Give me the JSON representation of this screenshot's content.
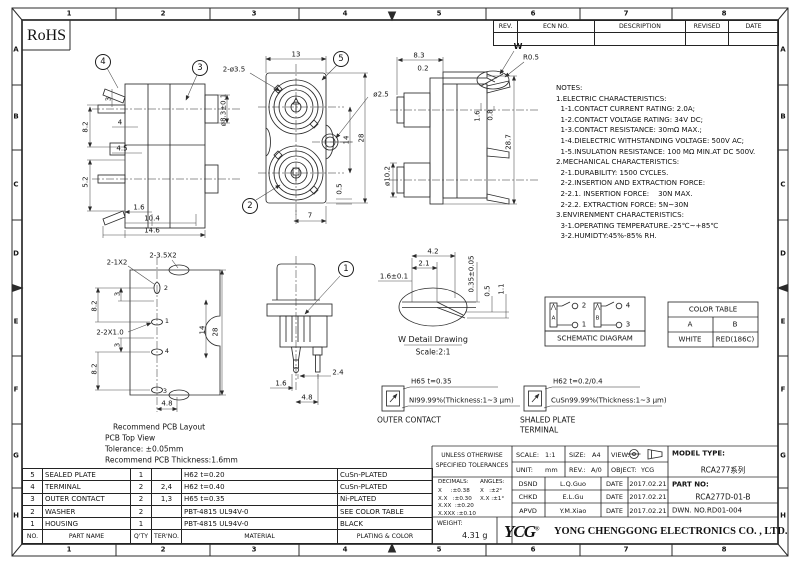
{
  "meta": {
    "background": "#ffffff",
    "line_color": "#2b2b2b",
    "text_color": "#111111"
  },
  "sheet": {
    "rohs_label": "RoHS"
  },
  "border": {
    "columns": [
      "1",
      "2",
      "3",
      "4",
      "5",
      "6",
      "7",
      "8"
    ],
    "rows": [
      "A",
      "B",
      "C",
      "D",
      "E",
      "F",
      "G",
      "H"
    ]
  },
  "revision_table": {
    "headers": [
      "REV.",
      "ECN NO.",
      "DESCRIPTION",
      "REVISED",
      "DATE"
    ]
  },
  "notes": {
    "title": "NOTES:",
    "lines": [
      "1.ELECTRIC CHARACTERISTICS:",
      "  1-1.CONTACT CURRENT RATING: 2.0A;",
      "  1-2.CONTACT VOLTAGE RATING: 34V DC;",
      "  1-3.CONTACT RESISTANCE: 30mΩ MAX.;",
      "  1-4.DIELECTRIC WITHSTANDING VOLTAGE: 500V AC;",
      "  1-5.INSULATION RESISTANCE: 100 MΩ MIN.AT DC 500V.",
      "2.MECHANICAL CHARACTERISTICS:",
      "  2-1.DURABILITY: 1500 CYCLES.",
      "  2-2.INSERTION AND EXTRACTION FORCE:",
      "  2-2.1. INSERTION FORCE:    30N MAX.",
      "  2-2.2. EXTRACTION FORCE: 5N~30N",
      "3.ENVIRENMENT CHARACTERISTICS:",
      "  3-1.OPERATING TEMPERATURE.-25℃~+85℃",
      "  3-2.HUMIDTY:45%-85% RH."
    ]
  },
  "views": {
    "dual_side": {
      "balloon_sealed_plate": "4",
      "balloon_outer_contact": "3",
      "dims": [
        "3",
        "8.2",
        "4",
        "4.5",
        "5.2",
        "1.6",
        "10.4",
        "14.6",
        "ø8.3±0.1"
      ]
    },
    "front": {
      "balloon_housing": "5",
      "balloon_washer": "2",
      "dims": [
        "13",
        "2-ø3.5",
        "ø2.5",
        "14",
        "28",
        "0.5",
        "7"
      ]
    },
    "right_side": {
      "detail_marker": "W",
      "dims": [
        "8.3",
        "0.2",
        "R0.5",
        "1.6",
        "0.8",
        "28.7",
        "ø10.2"
      ]
    },
    "pcb": {
      "dims": [
        "2-1X2",
        "2-3.5X2",
        "2-2X1.0",
        "3",
        "8.2",
        "3",
        "8.2",
        "14",
        "28",
        "4.8"
      ],
      "pads": [
        "2",
        "1",
        "4",
        "3"
      ],
      "caption": [
        "Recommend PCB Layout",
        "PCB Top View",
        "Tolerance: ±0.05mm",
        "Recommend PCB Thickness:1.6mm"
      ]
    },
    "single": {
      "balloon_housing": "1",
      "dims": [
        "1.6",
        "2.4",
        "4.8"
      ]
    },
    "w_detail": {
      "dims": [
        "4.2",
        "2.1",
        "1.6±0.1",
        "0.35±0.05",
        "0.5",
        "1.1"
      ],
      "title": "W Detail Drawing",
      "scale": "Scale:2:1"
    },
    "outer_contact": {
      "material": "H65 t=0.35",
      "plating": "NI99.99%(Thickness:1~3 μm)",
      "caption": "OUTER CONTACT"
    },
    "shaled_plate": {
      "material": "H62 t=0.2/0.4",
      "plating": "CuSn99.99%(Thickness:1~3 μm)",
      "caption_line1": "SHALED PLATE",
      "caption_line2": "TERMINAL"
    }
  },
  "schematic": {
    "caption": "SCHEMATIC DIAGRAM",
    "contact_a": "A",
    "contact_b": "B",
    "terminal_1": "1",
    "terminal_2": "2",
    "terminal_3": "3",
    "terminal_4": "4"
  },
  "color_table": {
    "title": "COLOR TABLE",
    "columns": [
      "A",
      "B"
    ],
    "values": [
      "WHITE",
      "RED(186C)"
    ]
  },
  "parts_table": {
    "headers": [
      "NO.",
      "PART NAME",
      "Q'TY",
      "TER'NO.",
      "MATERIAL",
      "PLATING & COLOR"
    ],
    "rows": [
      [
        "5",
        "SEALED PLATE",
        "1",
        "",
        "H62 t=0.20",
        "CuSn-PLATED"
      ],
      [
        "4",
        "TERMINAL",
        "2",
        "2,4",
        "H62 t=0.40",
        "CuSn-PLATED"
      ],
      [
        "3",
        "OUTER CONTACT",
        "2",
        "1,3",
        "H65 t=0.35",
        "Ni-PLATED"
      ],
      [
        "2",
        "WASHER",
        "2",
        "",
        "PBT-4815 UL94V-0",
        "SEE COLOR TABLE"
      ],
      [
        "1",
        "HOUSING",
        "1",
        "",
        "PBT-4815 UL94V-0",
        "BLACK"
      ]
    ]
  },
  "title_block": {
    "tolerance_title_line1": "UNLESS OTHERWISE",
    "tolerance_title_line2": "SPECIFIED TOLERANCES",
    "decimals_header": "DECIMALS:",
    "angles_header": "ANGLES:",
    "decimal_tolerances": [
      "X     :±0.38",
      "X.X   :±0.30",
      "X.XX  :±0.20",
      "X.XXX :±0.10"
    ],
    "angle_tolerances": [
      "X   :±2°",
      "X.X :±1°"
    ],
    "scale_label": "SCALE:",
    "scale_value": "1:1",
    "size_label": "SIZE:",
    "size_value": "A4",
    "view_label": "VIEW:",
    "unit_label": "UNIT:",
    "unit_value": "mm",
    "rev_label": "REV.:",
    "rev_value": "A/0",
    "object_label": "OBJECT:",
    "object_value": "YCG",
    "model_type_label": "MODEL TYPE:",
    "model_type_value": "RCA277系列",
    "part_no_label": "PART NO:",
    "part_no_value": "RCA277D-01-B",
    "dwn_no_label": "DWN. NO.:",
    "dwn_no_value": "RD01-004",
    "sign_rows": [
      {
        "role": "DSND",
        "name": "L.Q.Guo",
        "date_label": "DATE",
        "date": "2017.02.21"
      },
      {
        "role": "CHKD",
        "name": "E.L.Gu",
        "date_label": "DATE",
        "date": "2017.02.21"
      },
      {
        "role": "APVD",
        "name": "Y.M.Xiao",
        "date_label": "DATE",
        "date": "2017.02.21"
      }
    ],
    "weight_label": "WEIGHT:",
    "weight_value": "4.31 g",
    "logo_text": "YCG",
    "logo_reg": "®",
    "company": "YONG CHENGGONG ELECTRONICS CO. , LTD."
  }
}
